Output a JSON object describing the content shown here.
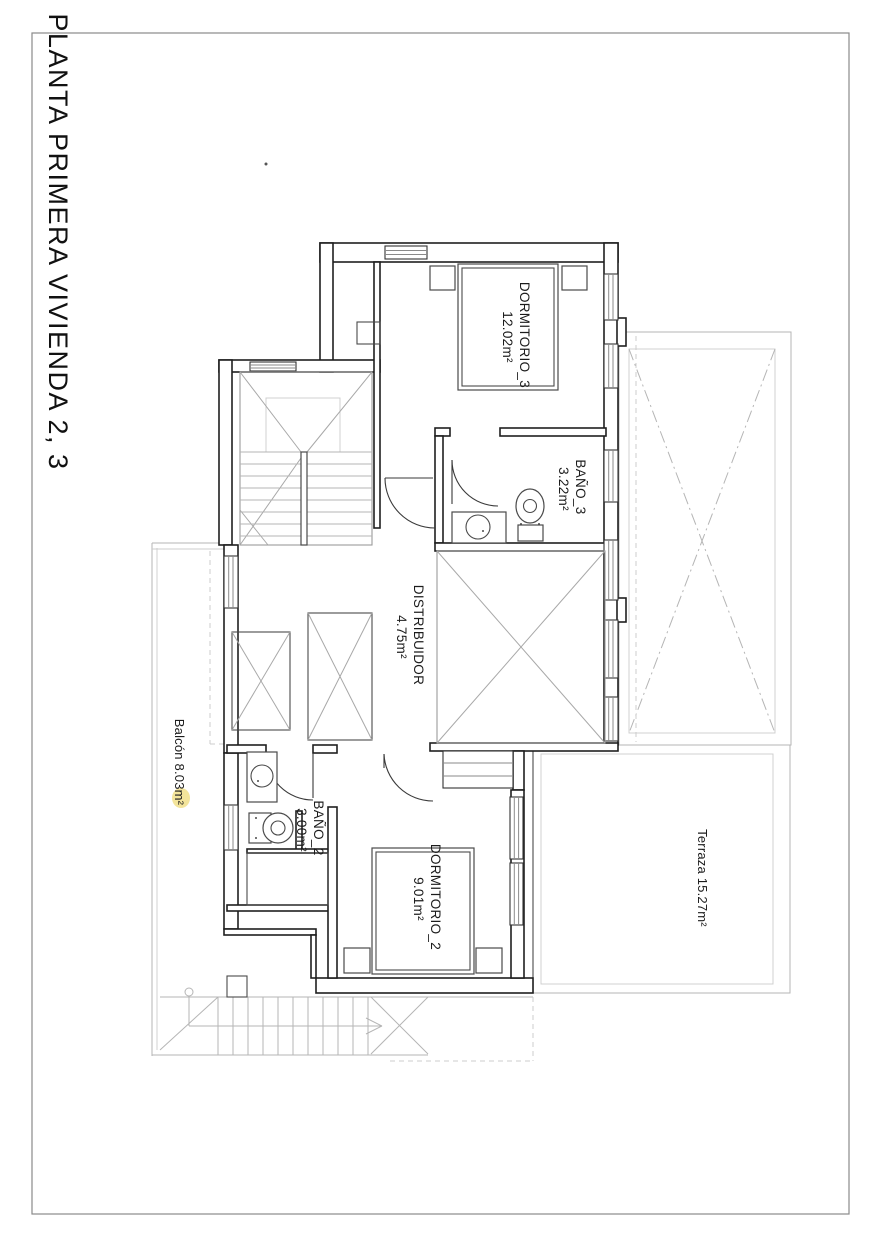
{
  "title": "PLANTA PRIMERA VIVIENDA 2, 3",
  "rooms": {
    "dormitorio3": {
      "name": "DORMITORIO_3",
      "area": "12.02m²"
    },
    "bano3": {
      "name": "BAÑO_3",
      "area": "3.22m²"
    },
    "distribuidor": {
      "name": "DISTRIBUIDOR",
      "area": "4.75m²"
    },
    "bano2": {
      "name": "BAÑO_2",
      "area": "3.00m²"
    },
    "dormitorio2": {
      "name": "DORMITORIO_2",
      "area": "9.01m²"
    },
    "terraza": {
      "label": "Terraza 15.27m²"
    },
    "balcon": {
      "label": "Balcón 8.03m²"
    }
  },
  "colors": {
    "wall": "#1f1f1f",
    "fixture": "#4a4a4a",
    "light": "#b5b5b5",
    "lighter": "#cccccc",
    "highlight": "#f3e49b",
    "text": "#1c1c1c",
    "border": "#8a8a8a"
  }
}
